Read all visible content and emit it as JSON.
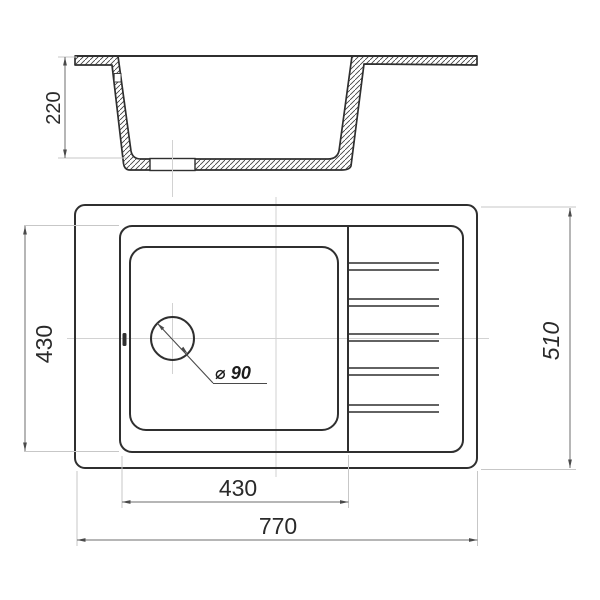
{
  "drawing": {
    "dims": {
      "section_depth": "220",
      "bowl_height": "430",
      "overall_height": "510",
      "bowl_width": "430",
      "overall_width": "770",
      "drain_diameter": "⌀ 90"
    },
    "colors": {
      "line": "#2f2f2f",
      "dimension": "#6e6e6e",
      "guide": "#d2d2d2",
      "arrow": "#4a4a4a",
      "background": "#ffffff"
    }
  }
}
